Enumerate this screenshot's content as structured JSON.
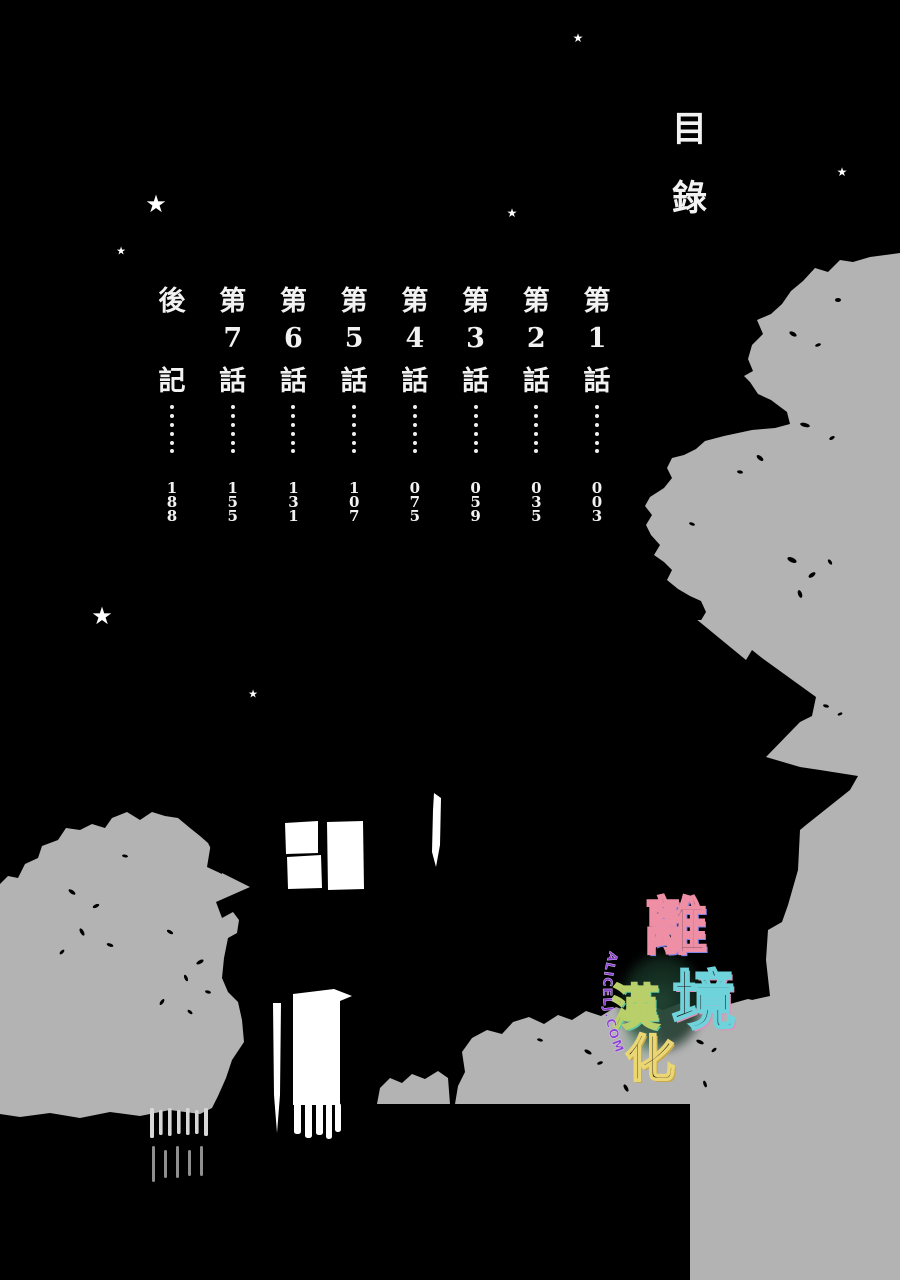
{
  "page": {
    "title": "目錄",
    "background_color": "#000000",
    "silhouette_gray": "#b3b3b3",
    "text_color": "#f2f2f2"
  },
  "toc": {
    "entries": [
      {
        "label": "第1話",
        "chars": [
          "第",
          "1",
          "話"
        ],
        "page": "003"
      },
      {
        "label": "第2話",
        "chars": [
          "第",
          "2",
          "話"
        ],
        "page": "035"
      },
      {
        "label": "第3話",
        "chars": [
          "第",
          "3",
          "話"
        ],
        "page": "059"
      },
      {
        "label": "第4話",
        "chars": [
          "第",
          "4",
          "話"
        ],
        "page": "075"
      },
      {
        "label": "第5話",
        "chars": [
          "第",
          "5",
          "話"
        ],
        "page": "107"
      },
      {
        "label": "第6話",
        "chars": [
          "第",
          "6",
          "話"
        ],
        "page": "131"
      },
      {
        "label": "第7話",
        "chars": [
          "第",
          "7",
          "話"
        ],
        "page": "155"
      },
      {
        "label": "後記",
        "chars": [
          "後",
          "",
          "記"
        ],
        "page": "188"
      }
    ]
  },
  "watermark": {
    "name": "離境漢化",
    "chars": [
      {
        "char": "離",
        "color": "#ee8fa6",
        "shadow": "#7b86e8"
      },
      {
        "char": "境",
        "color": "#6fd3dc",
        "shadow": "#e08fb8"
      },
      {
        "char": "漢",
        "color": "#b9d06a",
        "shadow": "#58c9a2"
      },
      {
        "char": "化",
        "color": "#ead672",
        "shadow": "#c9a84c"
      }
    ],
    "site_text": "ALICELJ.COM",
    "site_color": "#8b3fd0"
  },
  "stars": [
    {
      "x": 578,
      "y": 38,
      "fs": 12
    },
    {
      "x": 842,
      "y": 172,
      "fs": 12
    },
    {
      "x": 156,
      "y": 204,
      "fs": 24
    },
    {
      "x": 512,
      "y": 213,
      "fs": 12
    },
    {
      "x": 121,
      "y": 251,
      "fs": 11
    },
    {
      "x": 102,
      "y": 616,
      "fs": 24
    },
    {
      "x": 253,
      "y": 694,
      "fs": 11
    }
  ]
}
